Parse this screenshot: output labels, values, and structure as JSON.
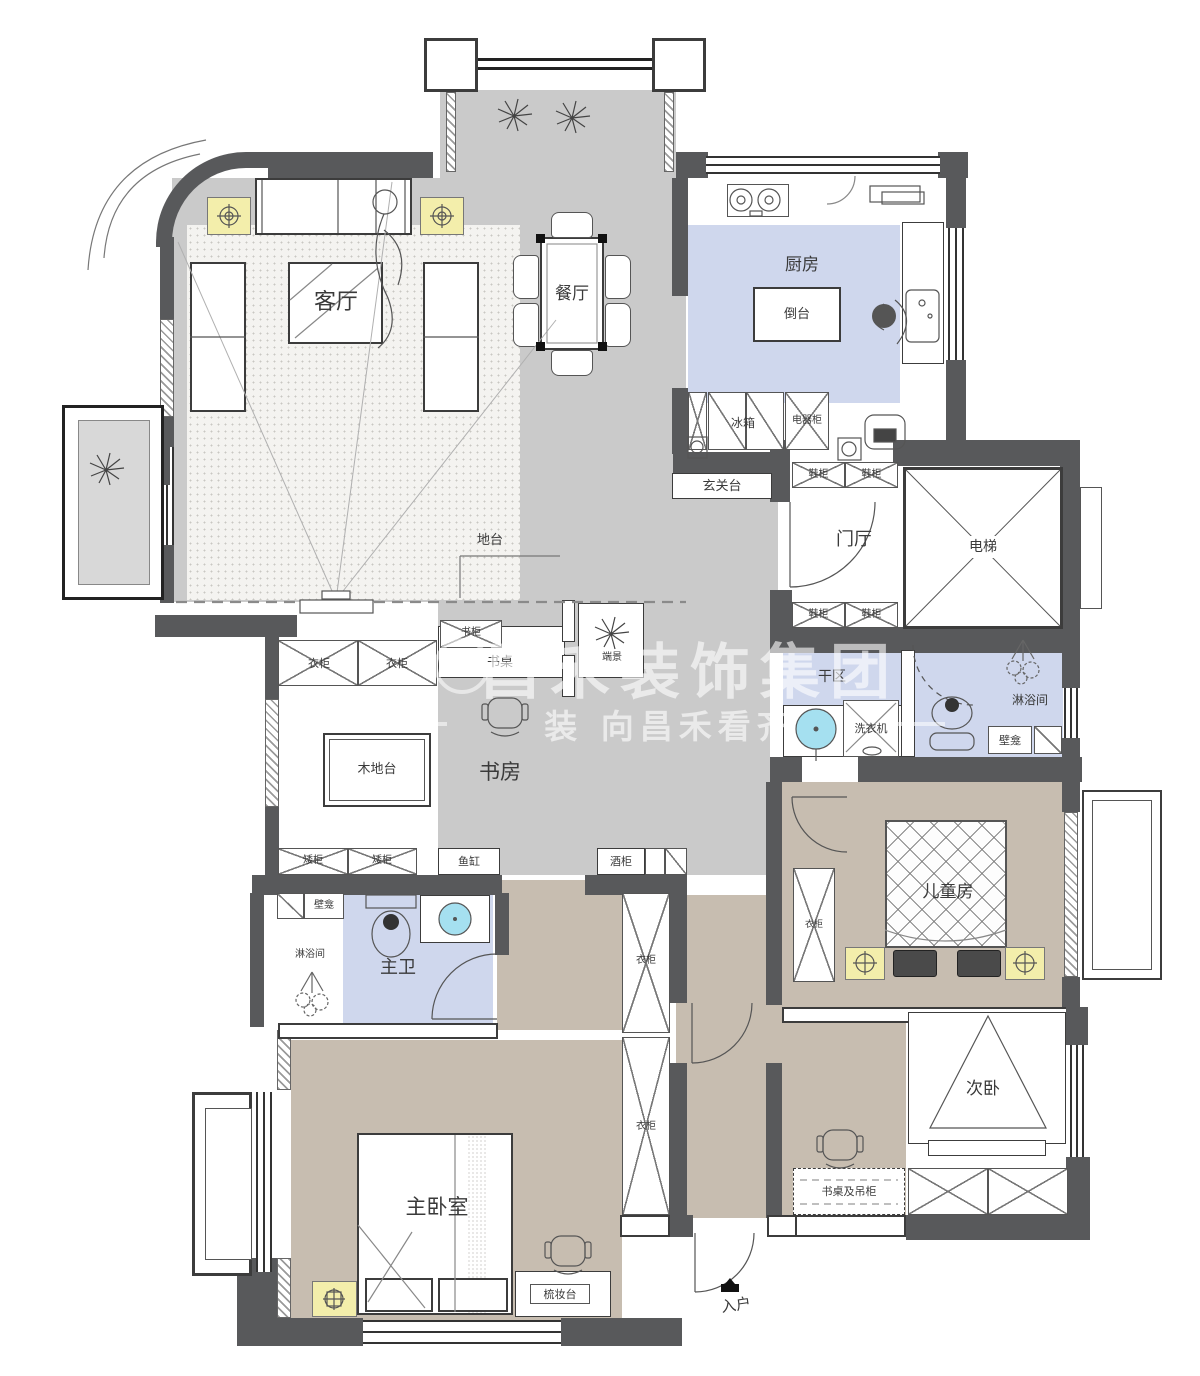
{
  "meta": {
    "kind": "apartment-floor-plan",
    "language": "zh-CN"
  },
  "watermark": {
    "line1": "昌禾装饰集团",
    "line2": "装 向昌禾看齐"
  },
  "colors": {
    "wall": "#58595b",
    "floor_gray": "#cacaca",
    "floor_tan": "#c7bdb0",
    "floor_blue": "#cfd7ed",
    "rug": "#f4f3f0",
    "lamp_yellow": "#f3eeab",
    "water_blue": "#a5e0f0",
    "line": "#555555",
    "watermark_text": "rgba(255,255,255,0.6)"
  },
  "icons": {
    "lamp": "target-circle-icon",
    "plant": "plant-scribble-icon",
    "person": "person-figure-icon",
    "shower": "shower-spray-icon",
    "toilet": "toilet-icon",
    "basin": "round-basin-icon",
    "house": "entry-house-icon"
  },
  "labels": {
    "living_room": "客厅",
    "dining_room": "餐厅",
    "kitchen": "厨房",
    "island": "倒台",
    "fridge": "冰箱",
    "appliance_cabinet": "电器柜",
    "entry_console": "玄关台",
    "foyer": "门厅",
    "elevator": "电梯",
    "shoe_cabinet": "鞋柜",
    "dry_area": "干区",
    "washer": "洗衣机",
    "shower_room": "淋浴间",
    "niche": "壁龛",
    "platform": "地台",
    "wood_platform": "木地台",
    "study": "书房",
    "bookcase": "书柜",
    "desk": "书桌",
    "end_view": "端景",
    "wardrobe": "衣柜",
    "low_cabinet": "矮柜",
    "fish_tank": "鱼缸",
    "wine_cabinet": "酒柜",
    "kids_room": "儿童房",
    "master_bath": "主卫",
    "master_bedroom": "主卧室",
    "dresser": "梳妆台",
    "second_bedroom": "次卧",
    "desk_hanging": "书桌及吊柜",
    "entrance": "入户"
  }
}
